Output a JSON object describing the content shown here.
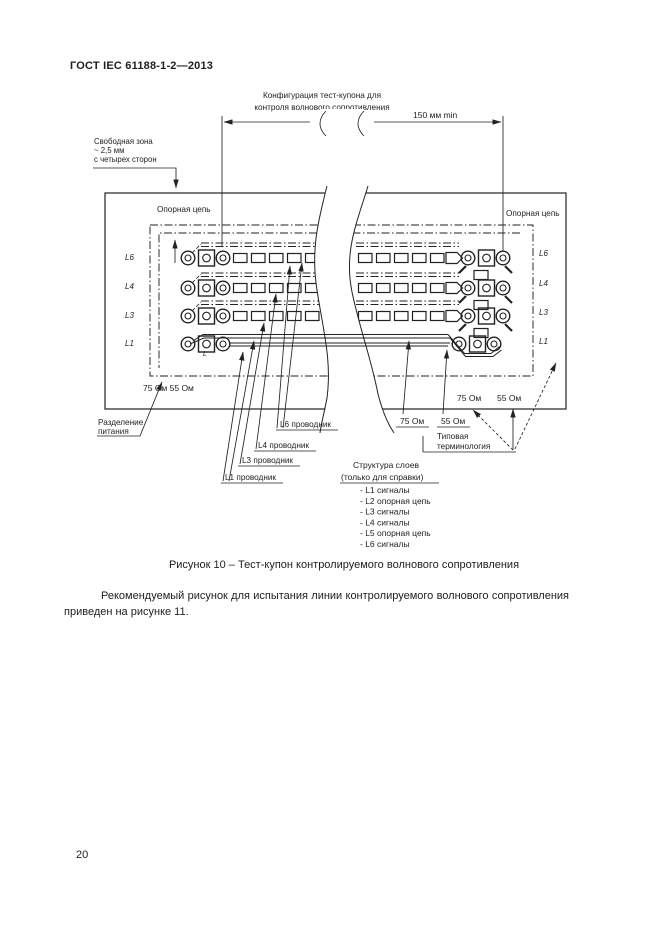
{
  "page": {
    "header": "ГОСТ IEC 61188-1-2—2013",
    "page_number": "20",
    "caption": "Рисунок 10 – Тест-купон контролируемого волнового сопротивления",
    "body_paragraph": "Рекомендуемый рисунок для испытания линии контролируемого волнового сопротивления приведен на рисунке 11."
  },
  "diagram": {
    "config_label": {
      "line1": "Конфигурация тест-купона для",
      "line2": "контроля волнового сопротивления"
    },
    "dimension_label": "150 мм min",
    "free_zone": {
      "line1": "Свободная зона",
      "line2": "~ 2,5 мм",
      "line3": "с четырех сторон"
    },
    "reference_circuit_left": "Опорная цепь",
    "reference_circuit_right": "Опорная цепь",
    "layer_labels_left": [
      "L6",
      "L4",
      "L3",
      "L1"
    ],
    "layer_labels_right": [
      "L6",
      "L4",
      "L3",
      "L1"
    ],
    "impedance_inline_left": "75 Ом 55 Ом",
    "impedance_inline_right_75": "75 Ом",
    "impedance_inline_right_55": "55 Ом",
    "power_separation": {
      "line1": "Разделение",
      "line2": "питания"
    },
    "conductor_labels": [
      "L6 проводник",
      "L4 проводник",
      "L3 проводник",
      "L1 проводник"
    ],
    "ohm_75_label": "75 Ом",
    "ohm_55_label": "55 Ом",
    "terminology": {
      "line1": "Типовая",
      "line2": "терминология"
    },
    "pad_marker": "L",
    "layer_structure": {
      "title": "Структура слоев",
      "subtitle": "(только для справки)",
      "items": [
        "- L1 сигналы",
        "- L2 опорная цепь",
        "- L3 сигналы",
        "- L4 сигналы",
        "- L5 опорная цепь",
        "- L6 сигналы"
      ]
    }
  }
}
